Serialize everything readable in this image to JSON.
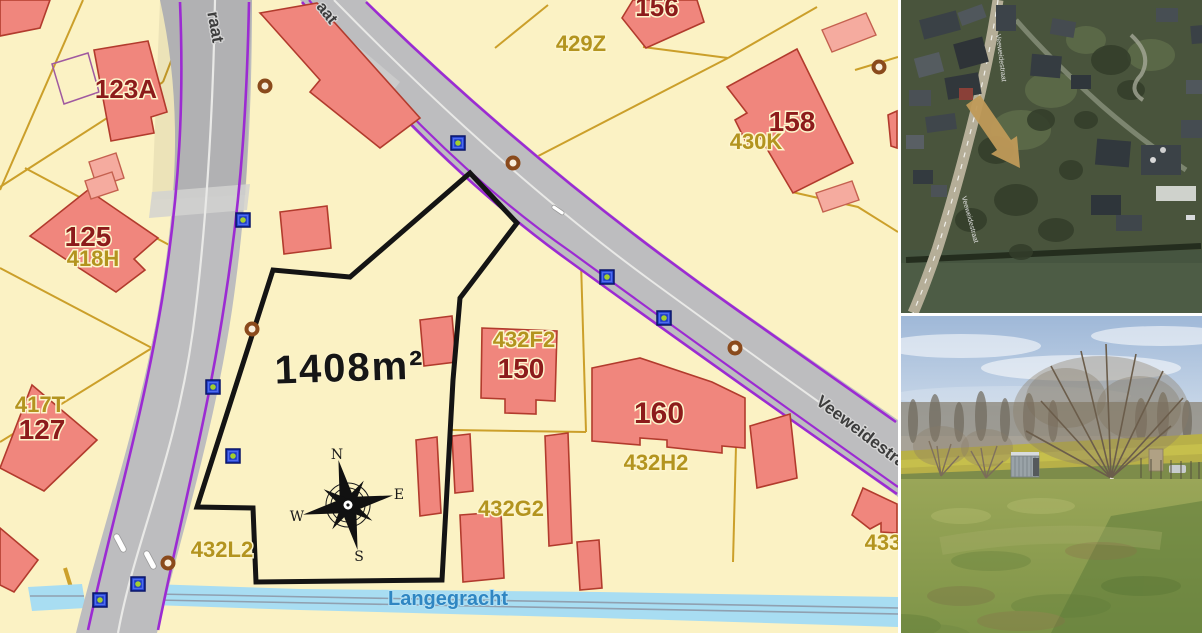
{
  "map": {
    "area_label": {
      "text": "1408m²",
      "x": 350,
      "y": 381,
      "size": 40,
      "rot": -2
    },
    "water_label": {
      "text": "Langegracht",
      "x": 448,
      "y": 605,
      "size": 20
    },
    "street_labels": [
      {
        "text": "raat",
        "x": 210,
        "y": 28,
        "rot": 80,
        "size": 17
      },
      {
        "text": "aat",
        "x": 323,
        "y": 16,
        "rot": 52,
        "size": 16
      },
      {
        "text": "Veeweidestra",
        "x": 858,
        "y": 436,
        "rot": 37,
        "size": 17
      }
    ],
    "house_numbers": [
      {
        "text": "123A",
        "x": 126,
        "y": 98,
        "size": 26
      },
      {
        "text": "125",
        "x": 88,
        "y": 246,
        "size": 28
      },
      {
        "text": "127",
        "x": 42,
        "y": 439,
        "size": 28
      },
      {
        "text": "150",
        "x": 521,
        "y": 378,
        "size": 28
      },
      {
        "text": "156",
        "x": 657,
        "y": 16,
        "size": 26
      },
      {
        "text": "158",
        "x": 792,
        "y": 131,
        "size": 28
      },
      {
        "text": "160",
        "x": 659,
        "y": 423,
        "size": 30
      }
    ],
    "parcel_numbers": [
      {
        "text": "418H",
        "x": 93,
        "y": 266,
        "size": 22
      },
      {
        "text": "417T",
        "x": 40,
        "y": 412,
        "size": 22
      },
      {
        "text": "432L2",
        "x": 222,
        "y": 557,
        "size": 22
      },
      {
        "text": "429Z",
        "x": 581,
        "y": 51,
        "size": 22
      },
      {
        "text": "430K",
        "x": 756,
        "y": 149,
        "size": 22
      },
      {
        "text": "432F2",
        "x": 524,
        "y": 347,
        "size": 22
      },
      {
        "text": "432H2",
        "x": 656,
        "y": 470,
        "size": 22
      },
      {
        "text": "432G2",
        "x": 511,
        "y": 516,
        "size": 22
      },
      {
        "text": "433I",
        "x": 886,
        "y": 550,
        "size": 22
      }
    ],
    "compass": {
      "letters": [
        {
          "text": "N",
          "x": 337,
          "y": 459
        },
        {
          "text": "E",
          "x": 399,
          "y": 499
        },
        {
          "text": "S",
          "x": 359,
          "y": 561
        },
        {
          "text": "W",
          "x": 297,
          "y": 521
        }
      ]
    },
    "markers": {
      "blue_squares": [
        {
          "x": 243,
          "y": 220
        },
        {
          "x": 213,
          "y": 387
        },
        {
          "x": 233,
          "y": 456
        },
        {
          "x": 138,
          "y": 584
        },
        {
          "x": 100,
          "y": 600
        },
        {
          "x": 458,
          "y": 143
        },
        {
          "x": 607,
          "y": 277
        },
        {
          "x": 664,
          "y": 318
        }
      ],
      "brown_circles": [
        {
          "x": 265,
          "y": 86
        },
        {
          "x": 252,
          "y": 329
        },
        {
          "x": 168,
          "y": 563
        },
        {
          "x": 513,
          "y": 163
        },
        {
          "x": 735,
          "y": 348
        },
        {
          "x": 879,
          "y": 67
        }
      ]
    },
    "colors": {
      "parcel_background": "#fbf2c4",
      "building_fill": "#f0867d",
      "building_light_fill": "#f5ab9f",
      "parcel_line": "#c99b22",
      "road_fill": "#bdbdbf",
      "road_edge_purple": "#9c2bd2",
      "highlight_outline": "#141414",
      "water_fill": "#a8ddf2",
      "house_label": "#8c1b1b",
      "parcel_label": "#b3941f",
      "water_label": "#2f86c2"
    }
  },
  "aerial": {
    "street_label": "Veeweidestraat"
  },
  "ground": {}
}
